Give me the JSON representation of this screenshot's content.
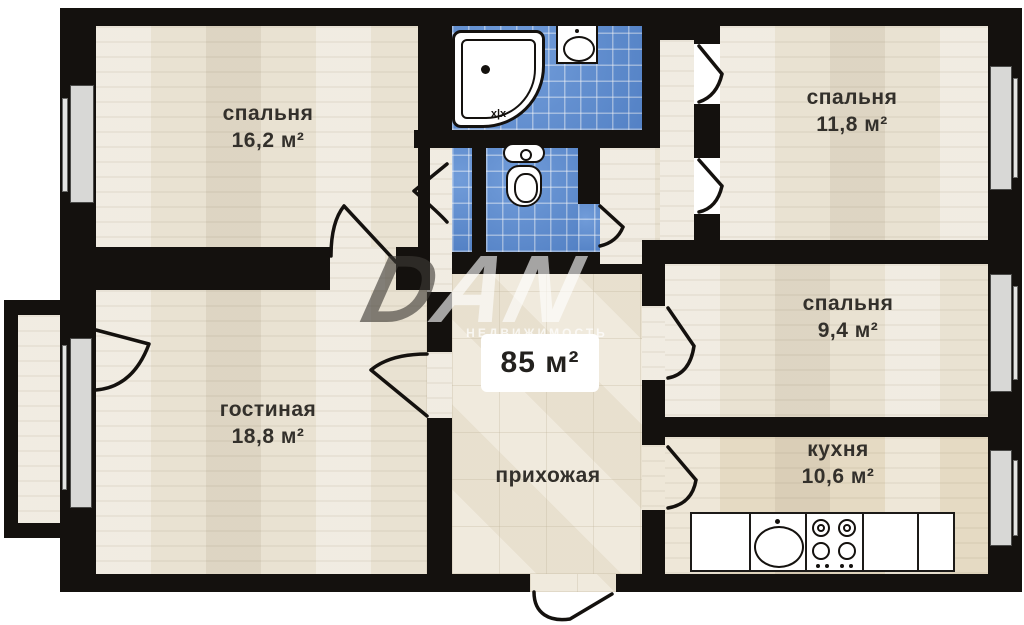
{
  "floorplan": {
    "total_area": "85 м²",
    "watermark": {
      "logo_first": "D",
      "logo_rest": "AN",
      "subtext": "НЕДВИЖИМОСТЬ"
    },
    "rooms": [
      {
        "name": "спальня",
        "area": "16,2 м²"
      },
      {
        "name": "спальня",
        "area": "11,8 м²"
      },
      {
        "name": "спальня",
        "area": "9,4 м²"
      },
      {
        "name": "гостиная",
        "area": "18,8 м²"
      },
      {
        "name": "кухня",
        "area": "10,6 м²"
      },
      {
        "name": "прихожая",
        "area": ""
      }
    ],
    "fixtures": {
      "bathtub_tap": "x|x"
    },
    "colors": {
      "wall": "#14110e",
      "tile_blue": "#5a8cd3",
      "floor_wood": "#e9e2d2",
      "floor_hall": "#ece5d5",
      "window_gray": "#d8d8d6",
      "background": "#ffffff"
    }
  }
}
